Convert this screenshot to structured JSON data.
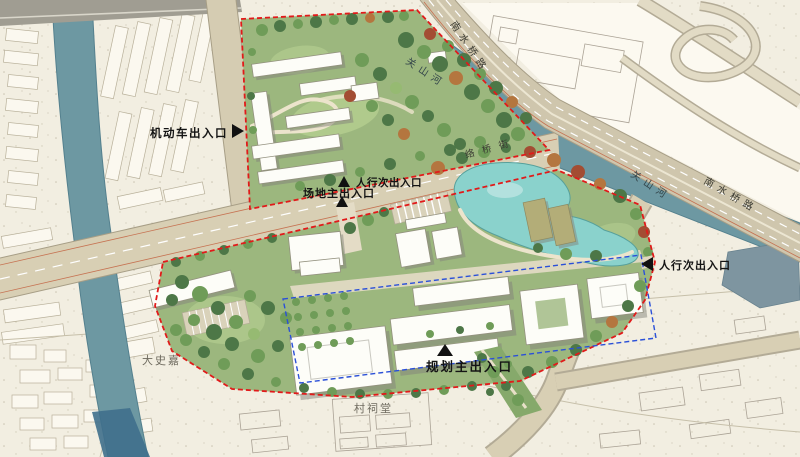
{
  "plan": {
    "entrances": {
      "motor": {
        "label": "机动车出入口",
        "arrow": "right"
      },
      "ped_secondary_north": {
        "label": "人行次出入口",
        "arrow": "up"
      },
      "site_main": {
        "label": "场地主出入口",
        "arrow": "up"
      },
      "ped_secondary_east": {
        "label": "人行次出入口",
        "arrow": "left"
      },
      "planned_main": {
        "label": "规划主出入口",
        "arrow": "up"
      }
    },
    "roads": {
      "nanshuiqiao_north": "南水桥路",
      "nanshuiqiao_east": "南水桥路",
      "luoqiao_mid": "络桥街"
    },
    "rivers": {
      "guanshan_nw": "关山河",
      "guanshan_east": "关山河"
    },
    "places": {
      "dashijia": "大史嘉",
      "cun_citang": "村祠堂"
    },
    "colors": {
      "site_boundary_red": "#e11a1a",
      "building_outline_blue": "#2b50d8",
      "river": "#6d98a2",
      "pond": "#8ad2cc",
      "road": "#d8cfb4",
      "paper": "#f2eee1",
      "green_base": "#9cb77e"
    }
  }
}
